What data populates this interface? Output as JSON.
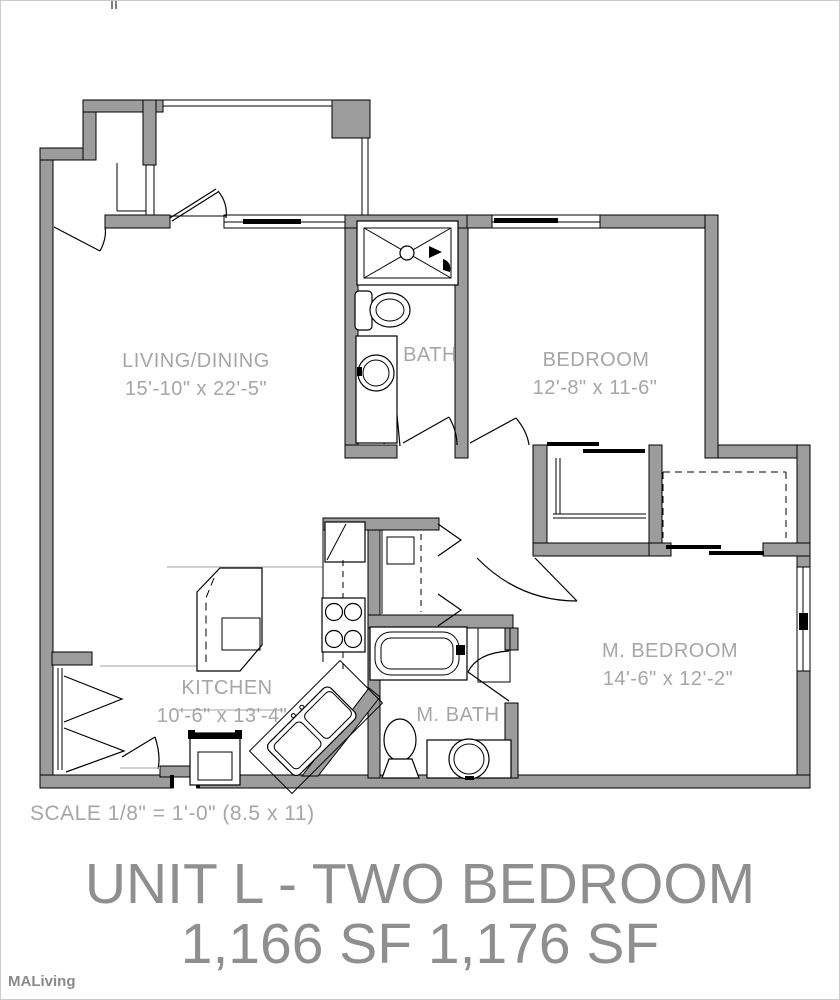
{
  "document": {
    "title_line1": "UNIT L - TWO BEDROOM",
    "title_line2": "1,166 SF   1,176 SF",
    "scale_note": "SCALE  1/8\" = 1'-0\" (8.5 x 11)",
    "watermark": "MALiving"
  },
  "colors": {
    "wall": "#9c9c9c",
    "outline": "#000000",
    "room_label": "#a6a6a6",
    "title": "#8f8f8f",
    "watermark": "#8a8a8a",
    "break_line": "#b3b3b3",
    "page_border": "#c9c9c9"
  },
  "rooms": {
    "living": {
      "name": "LIVING/DINING",
      "dims": "15'-10\" x 22'-5\""
    },
    "bath": {
      "name": "BATH"
    },
    "bedroom": {
      "name": "BEDROOM",
      "dims": "12'-8\" x 11-6\""
    },
    "kitchen": {
      "name": "KITCHEN",
      "dims": "10'-6\" x 13'-4\""
    },
    "master_bath": {
      "name": "M. BATH"
    },
    "master_bedroom": {
      "name": "M. BEDROOM",
      "dims": "14'-6\" x 12'-2\""
    }
  }
}
